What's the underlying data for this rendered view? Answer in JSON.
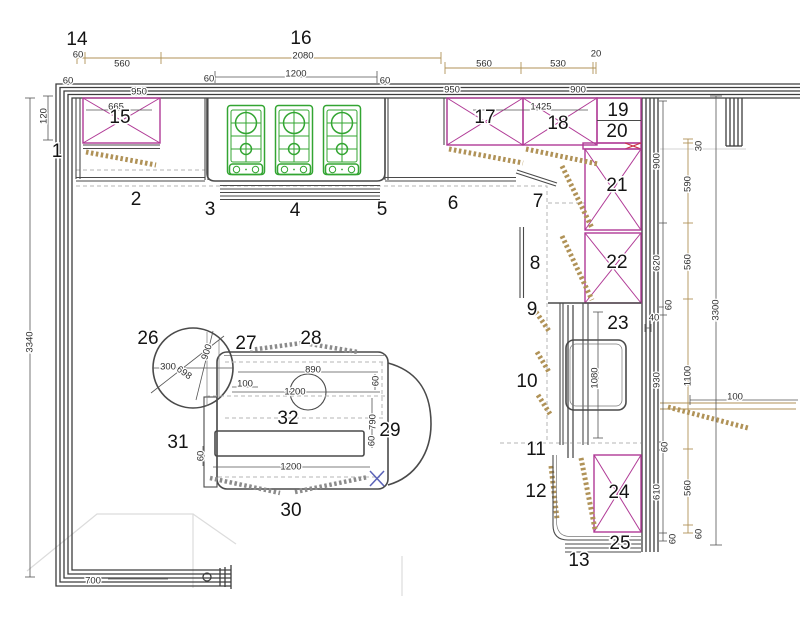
{
  "title": "Kitchen floor plan with numbered callouts and dimensions",
  "colors": {
    "wall": "#3d3d3d",
    "cabinet_line": "#4a4a4a",
    "cabinet_cross": "#b03a96",
    "highlight_cross": "#cc3344",
    "hob_green": "#33a532",
    "dimension_tan": "#b09257",
    "dashed_gray": "#b5b5b5",
    "faint_gray": "#dcdcdc",
    "marker_blue": "#5b63b8"
  },
  "callouts": [
    {
      "n": "1",
      "x": 57,
      "y": 152
    },
    {
      "n": "2",
      "x": 136,
      "y": 200
    },
    {
      "n": "3",
      "x": 210,
      "y": 210
    },
    {
      "n": "4",
      "x": 295,
      "y": 211
    },
    {
      "n": "5",
      "x": 382,
      "y": 210
    },
    {
      "n": "6",
      "x": 453,
      "y": 204
    },
    {
      "n": "7",
      "x": 538,
      "y": 202
    },
    {
      "n": "8",
      "x": 535,
      "y": 264
    },
    {
      "n": "9",
      "x": 532,
      "y": 310
    },
    {
      "n": "10",
      "x": 527,
      "y": 382
    },
    {
      "n": "11",
      "x": 536,
      "y": 450
    },
    {
      "n": "12",
      "x": 536,
      "y": 492
    },
    {
      "n": "13",
      "x": 579,
      "y": 561
    },
    {
      "n": "14",
      "x": 77,
      "y": 40
    },
    {
      "n": "15",
      "x": 120,
      "y": 118
    },
    {
      "n": "16",
      "x": 301,
      "y": 39
    },
    {
      "n": "17",
      "x": 485,
      "y": 118
    },
    {
      "n": "18",
      "x": 558,
      "y": 124
    },
    {
      "n": "19",
      "x": 618,
      "y": 111
    },
    {
      "n": "20",
      "x": 617,
      "y": 132
    },
    {
      "n": "21",
      "x": 617,
      "y": 186
    },
    {
      "n": "22",
      "x": 617,
      "y": 263
    },
    {
      "n": "23",
      "x": 618,
      "y": 324
    },
    {
      "n": "24",
      "x": 619,
      "y": 493
    },
    {
      "n": "25",
      "x": 620,
      "y": 544
    },
    {
      "n": "26",
      "x": 148,
      "y": 339
    },
    {
      "n": "27",
      "x": 246,
      "y": 344
    },
    {
      "n": "28",
      "x": 311,
      "y": 339
    },
    {
      "n": "29",
      "x": 390,
      "y": 431
    },
    {
      "n": "30",
      "x": 291,
      "y": 511
    },
    {
      "n": "31",
      "x": 178,
      "y": 443
    },
    {
      "n": "32",
      "x": 288,
      "y": 419
    }
  ],
  "dimensions": [
    {
      "t": "60",
      "x": 78,
      "y": 55,
      "rot": 0
    },
    {
      "t": "560",
      "x": 122,
      "y": 64,
      "rot": 0
    },
    {
      "t": "2080",
      "x": 303,
      "y": 56,
      "rot": 0
    },
    {
      "t": "1200",
      "x": 296,
      "y": 74,
      "rot": 0
    },
    {
      "t": "60",
      "x": 68,
      "y": 81,
      "rot": 0
    },
    {
      "t": "60",
      "x": 209,
      "y": 79,
      "rot": 0
    },
    {
      "t": "60",
      "x": 385,
      "y": 81,
      "rot": 0
    },
    {
      "t": "950",
      "x": 139,
      "y": 92,
      "rot": 0
    },
    {
      "t": "665",
      "x": 116,
      "y": 107,
      "rot": 0
    },
    {
      "t": "560",
      "x": 484,
      "y": 64,
      "rot": 0
    },
    {
      "t": "530",
      "x": 558,
      "y": 64,
      "rot": 0
    },
    {
      "t": "20",
      "x": 596,
      "y": 54,
      "rot": 0
    },
    {
      "t": "950",
      "x": 452,
      "y": 90,
      "rot": 0
    },
    {
      "t": "900",
      "x": 578,
      "y": 90,
      "rot": 0
    },
    {
      "t": "1425",
      "x": 541,
      "y": 107,
      "rot": 0
    },
    {
      "t": "120",
      "x": 44,
      "y": 116,
      "rot": -90
    },
    {
      "t": "3340",
      "x": 30,
      "y": 342,
      "rot": -90
    },
    {
      "t": "700",
      "x": 93,
      "y": 581,
      "rot": 0
    },
    {
      "t": "900",
      "x": 657,
      "y": 161,
      "rot": -90
    },
    {
      "t": "620",
      "x": 657,
      "y": 263,
      "rot": -90
    },
    {
      "t": "60",
      "x": 669,
      "y": 305,
      "rot": -90
    },
    {
      "t": "40",
      "x": 654,
      "y": 318,
      "rot": 0
    },
    {
      "t": "930",
      "x": 657,
      "y": 380,
      "rot": -90
    },
    {
      "t": "60",
      "x": 665,
      "y": 447,
      "rot": -90
    },
    {
      "t": "610",
      "x": 657,
      "y": 492,
      "rot": -90
    },
    {
      "t": "60",
      "x": 673,
      "y": 539,
      "rot": -90
    },
    {
      "t": "30",
      "x": 699,
      "y": 146,
      "rot": -90
    },
    {
      "t": "590",
      "x": 688,
      "y": 184,
      "rot": -90
    },
    {
      "t": "560",
      "x": 688,
      "y": 262,
      "rot": -90
    },
    {
      "t": "1100",
      "x": 688,
      "y": 376,
      "rot": -90
    },
    {
      "t": "560",
      "x": 688,
      "y": 488,
      "rot": -90
    },
    {
      "t": "60",
      "x": 699,
      "y": 534,
      "rot": -90
    },
    {
      "t": "3300",
      "x": 716,
      "y": 310,
      "rot": -90
    },
    {
      "t": "100",
      "x": 735,
      "y": 397,
      "rot": 0
    },
    {
      "t": "300",
      "x": 168,
      "y": 367,
      "rot": 0
    },
    {
      "t": "698",
      "x": 184,
      "y": 373,
      "rot": 35
    },
    {
      "t": "900",
      "x": 207,
      "y": 352,
      "rot": -72
    },
    {
      "t": "100",
      "x": 245,
      "y": 384,
      "rot": 0
    },
    {
      "t": "890",
      "x": 313,
      "y": 370,
      "rot": 0
    },
    {
      "t": "60",
      "x": 376,
      "y": 381,
      "rot": -90
    },
    {
      "t": "1200",
      "x": 295,
      "y": 392,
      "rot": 0
    },
    {
      "t": "790",
      "x": 373,
      "y": 422,
      "rot": -90
    },
    {
      "t": "60",
      "x": 372,
      "y": 441,
      "rot": -90
    },
    {
      "t": "1200",
      "x": 291,
      "y": 467,
      "rot": 0
    },
    {
      "t": "60",
      "x": 201,
      "y": 456,
      "rot": -90
    },
    {
      "t": "1080",
      "x": 595,
      "y": 378,
      "rot": -90
    }
  ]
}
